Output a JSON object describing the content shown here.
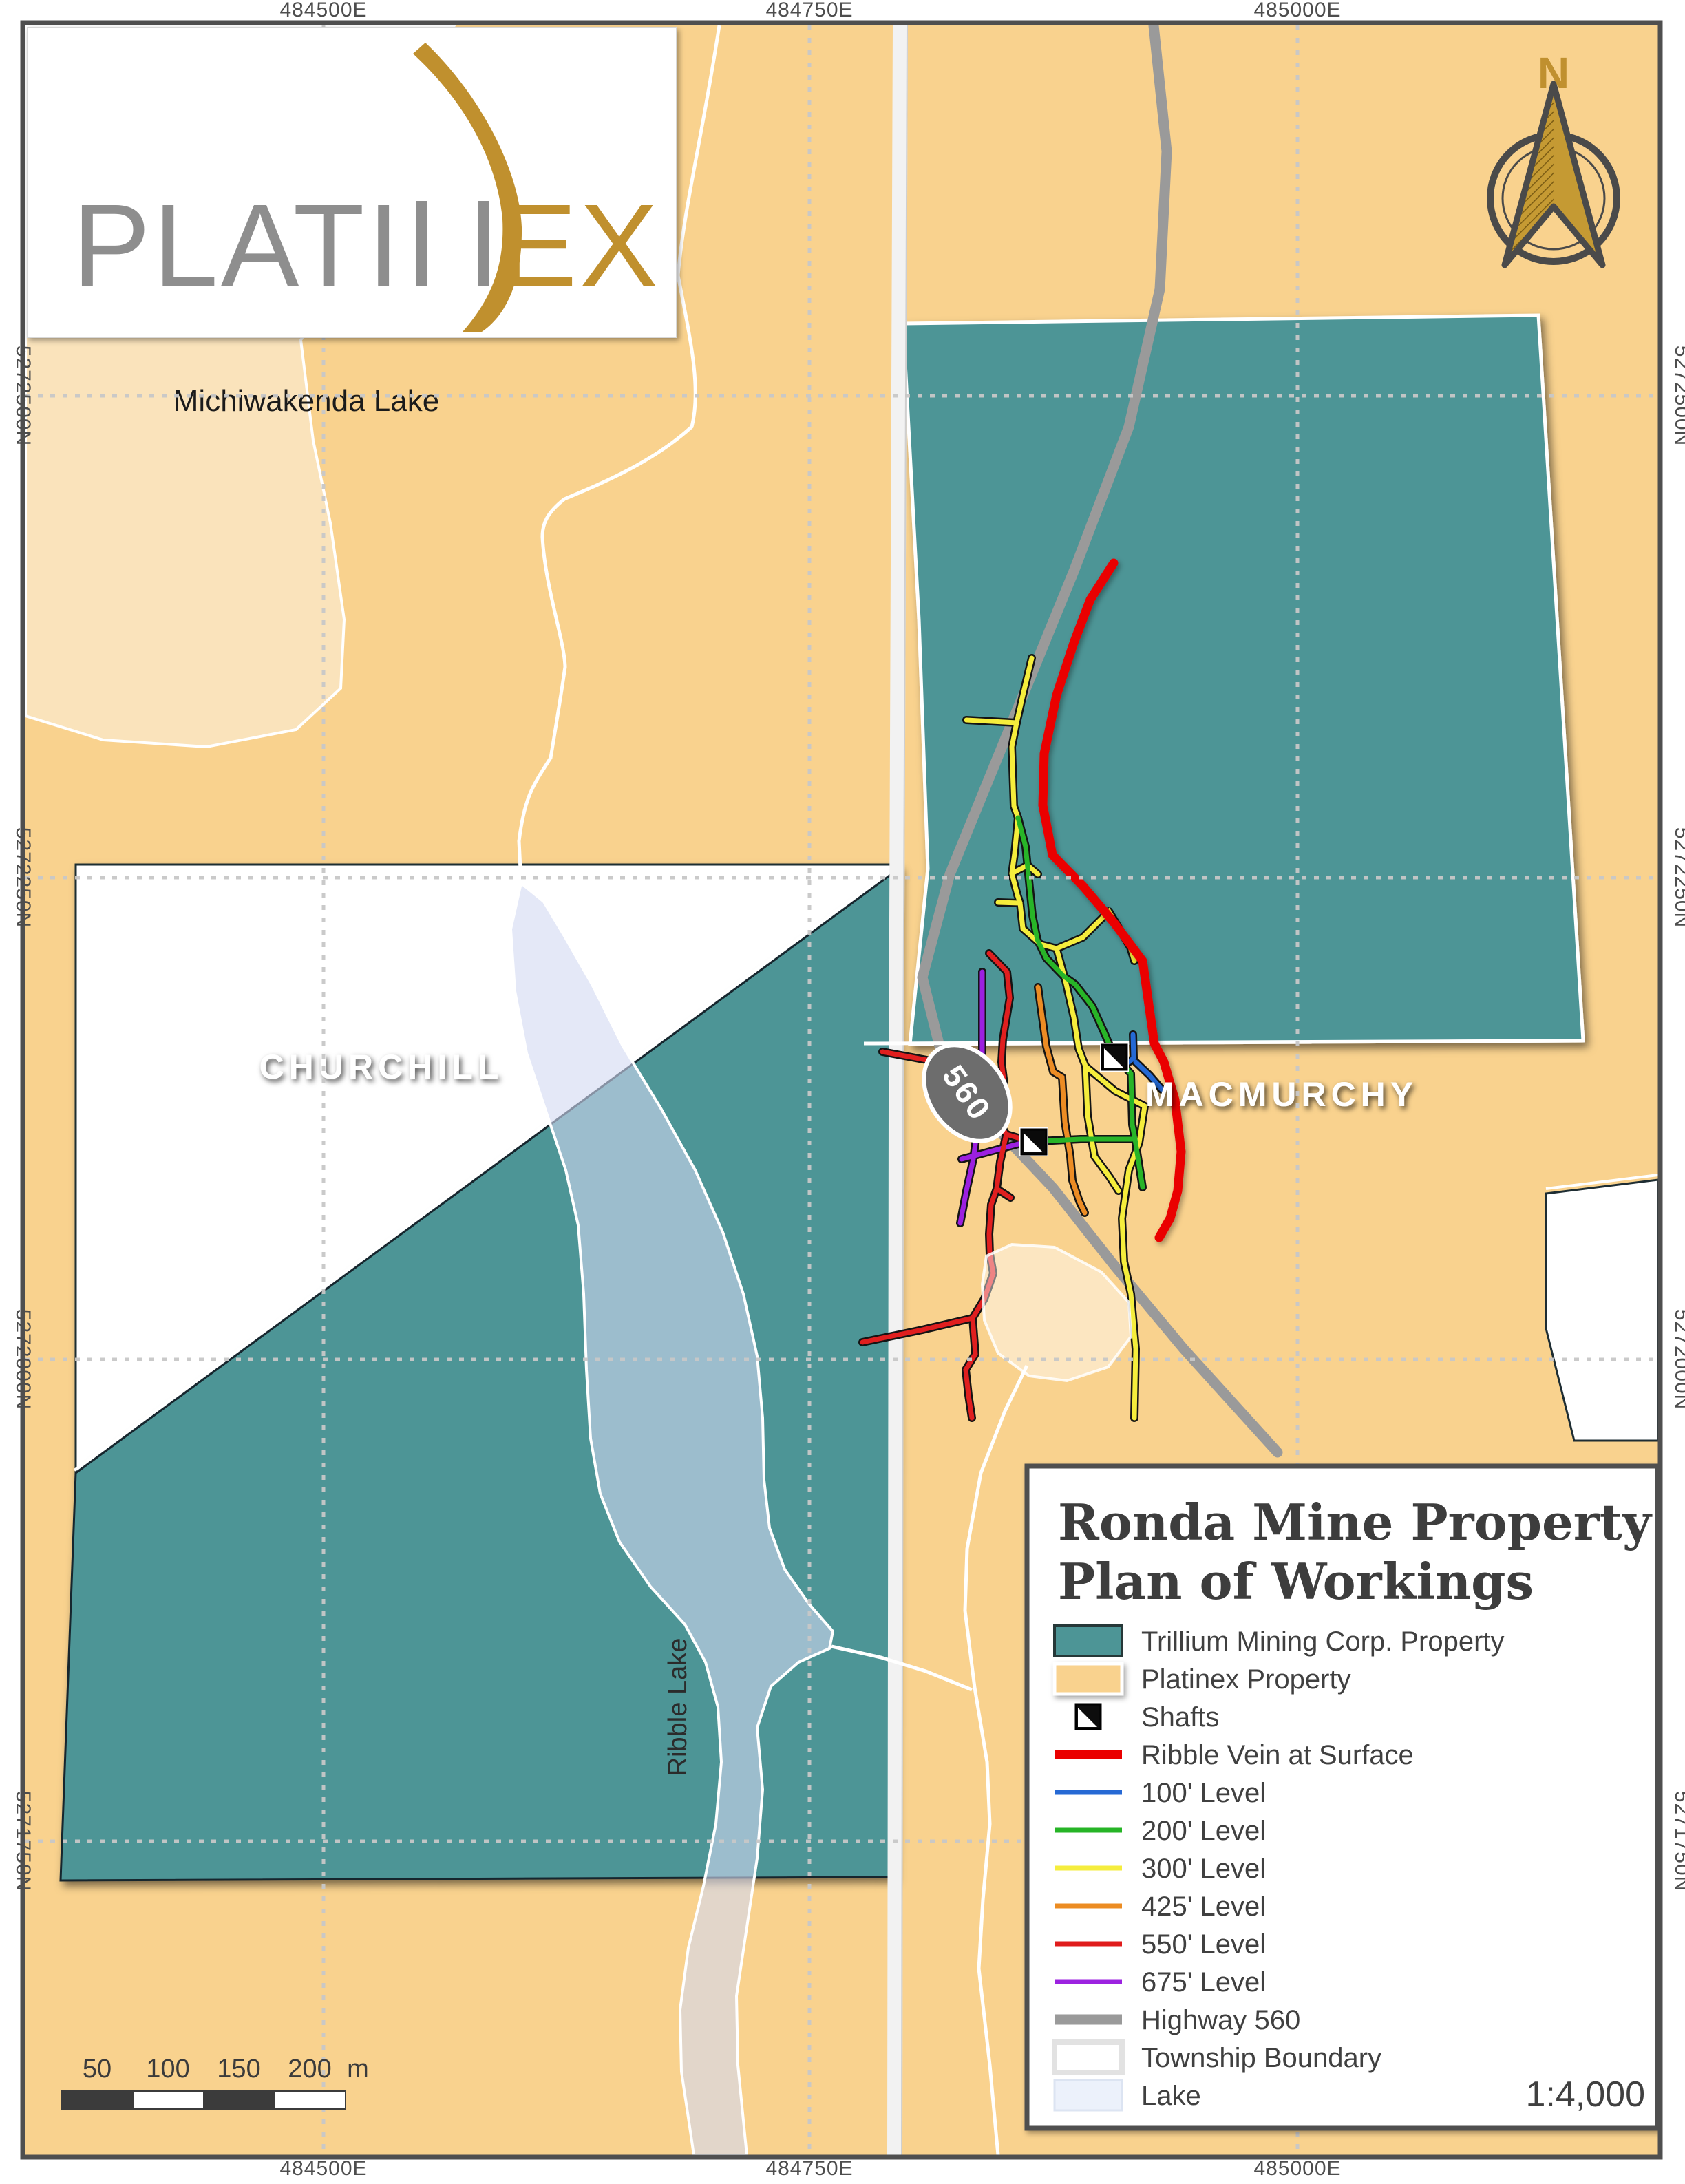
{
  "colors": {
    "tan": "#F9D28E",
    "pale_lake": "#FAE3BB",
    "teal": "#4E9596",
    "lake": "#D2D8F2",
    "road": "#F2F2F2",
    "highway": "#9A9A9A",
    "vein": "#EA0000",
    "frame": "#4F4F4F",
    "gold": "#C0902F",
    "logo_gray": "#8E8E8E",
    "shaft_black": "#0A0A0A",
    "levels": {
      "l100": "#2569D4",
      "l200": "#28B428",
      "l300": "#F5ED3C",
      "l425": "#EC8C24",
      "l550": "#E01F1F",
      "l675": "#9C20E0"
    }
  },
  "coordinates": {
    "eastings": [
      "484500E",
      "484750E",
      "485000E"
    ],
    "northings": [
      "5272500N",
      "5272250N",
      "5272000N",
      "5271750N"
    ]
  },
  "map_labels": {
    "lake_top": "Michiwakenda Lake",
    "township_left": "CHURCHILL",
    "township_right": "MACMURCHY",
    "lake_vertical": "Ribble Lake",
    "highway_shield": "560",
    "north_letter": "N"
  },
  "logo": {
    "text_gray": "PLATI",
    "text_gold": "EX"
  },
  "legend": {
    "title_line1": "Ronda Mine Property",
    "title_line2": "Plan of Workings",
    "items": [
      {
        "label": "Trillium Mining Corp. Property",
        "color": "#4E9596"
      },
      {
        "label": "Platinex Property",
        "color": "#F9D28E"
      },
      {
        "label": "Shafts",
        "color": "#0A0A0A"
      },
      {
        "label": "Ribble Vein at Surface",
        "color": "#EA0000"
      },
      {
        "label": "100' Level",
        "color": "#2569D4"
      },
      {
        "label": "200' Level",
        "color": "#28B428"
      },
      {
        "label": "300' Level",
        "color": "#F5ED3C"
      },
      {
        "label": "425' Level",
        "color": "#EC8C24"
      },
      {
        "label": "550' Level",
        "color": "#E01F1F"
      },
      {
        "label": "675' Level",
        "color": "#9C20E0"
      },
      {
        "label": "Highway 560",
        "color": "#9A9A9A"
      },
      {
        "label": "Township Boundary",
        "color": "#FFFFFF"
      },
      {
        "label": "Lake",
        "color": "#ECF1FB"
      }
    ],
    "scale_ratio": "1:4,000"
  },
  "scalebar": {
    "ticks": [
      "50",
      "100",
      "150",
      "200"
    ],
    "unit": "m"
  }
}
